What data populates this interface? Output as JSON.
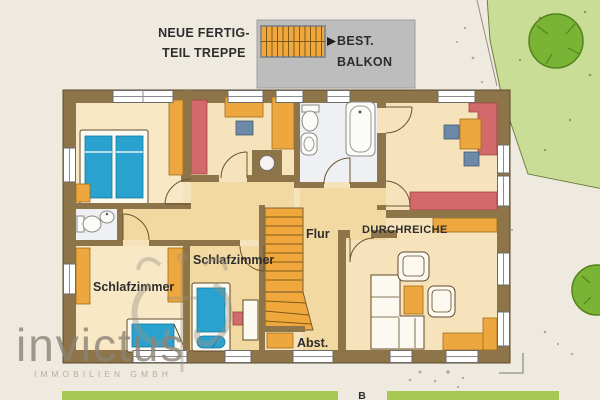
{
  "annotations": {
    "new_stair_line1": "NEUE FERTIG-",
    "new_stair_line2": "TEIL TREPPE",
    "balcony_line1": "BEST.",
    "balcony_line2": "BALKON"
  },
  "rooms": {
    "bedroom_sw_label": "Schlafzimmer",
    "bedroom_mid_label": "Schlafzimmer",
    "hall_label": "Flur",
    "pass_through_label": "DURCHREICHE",
    "storage_label": "Abst."
  },
  "site": {
    "section_marker": "B"
  },
  "watermark": {
    "name": "invictus",
    "subtitle": "IMMOBILIEN GMBH"
  },
  "colors": {
    "background": "#efeae0",
    "wall": "#8d7449",
    "floor": "#f7e3bb",
    "floor_light": "#f9e8c6",
    "floor_hall": "#f2d9a2",
    "bath_floor": "#eef0f3",
    "furniture_orange": "#eea73f",
    "furniture_red": "#d2696a",
    "furniture_blue": "#29a2cf",
    "chair_gray_blue": "#6d89a8",
    "furniture_white": "#fcf9f0",
    "balcony_gray": "#bdbdbd",
    "stair_orange": "#f0a83c",
    "garden_green": "#cadd97",
    "tree_green": "#79b434",
    "tree_outline": "#54831d",
    "hedge_green": "#a7c853",
    "label_color": "#2d2d2d",
    "watermark_gray": "#8b8475"
  }
}
